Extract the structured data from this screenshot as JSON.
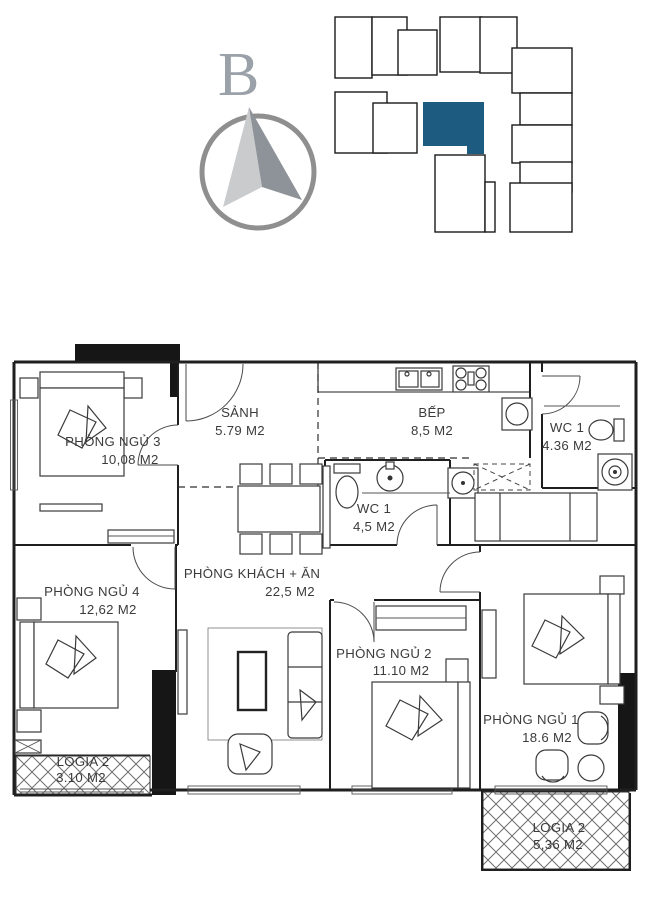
{
  "compass": {
    "label": "B"
  },
  "key_plan": {
    "highlight_color": "#1d5b80"
  },
  "rooms": [
    {
      "id": "sanh",
      "name": "SẢNH",
      "area": "5.79 M2"
    },
    {
      "id": "bep",
      "name": "BẾP",
      "area": "8,5 M2"
    },
    {
      "id": "wc1-top",
      "name": "WC 1",
      "area": "4.36 M2"
    },
    {
      "id": "wc1-mid",
      "name": "WC 1",
      "area": "4,5 M2"
    },
    {
      "id": "pn3",
      "name": "PHÒNG NGỦ 3",
      "area": "10,08 M2"
    },
    {
      "id": "pn4",
      "name": "PHÒNG NGỦ 4",
      "area": "12,62 M2"
    },
    {
      "id": "khach-an",
      "name": "PHÒNG KHÁCH + ĂN",
      "area": "22,5 M2"
    },
    {
      "id": "pn2",
      "name": "PHÒNG NGỦ 2",
      "area": "11.10 M2"
    },
    {
      "id": "pn1",
      "name": "PHÒNG NGỦ 1",
      "area": "18.6 M2"
    },
    {
      "id": "logia-left",
      "name": "LOGIA 2",
      "area": "3.10 M2"
    },
    {
      "id": "logia-right",
      "name": "LOGIA 2",
      "area": "5,36 M2"
    }
  ]
}
